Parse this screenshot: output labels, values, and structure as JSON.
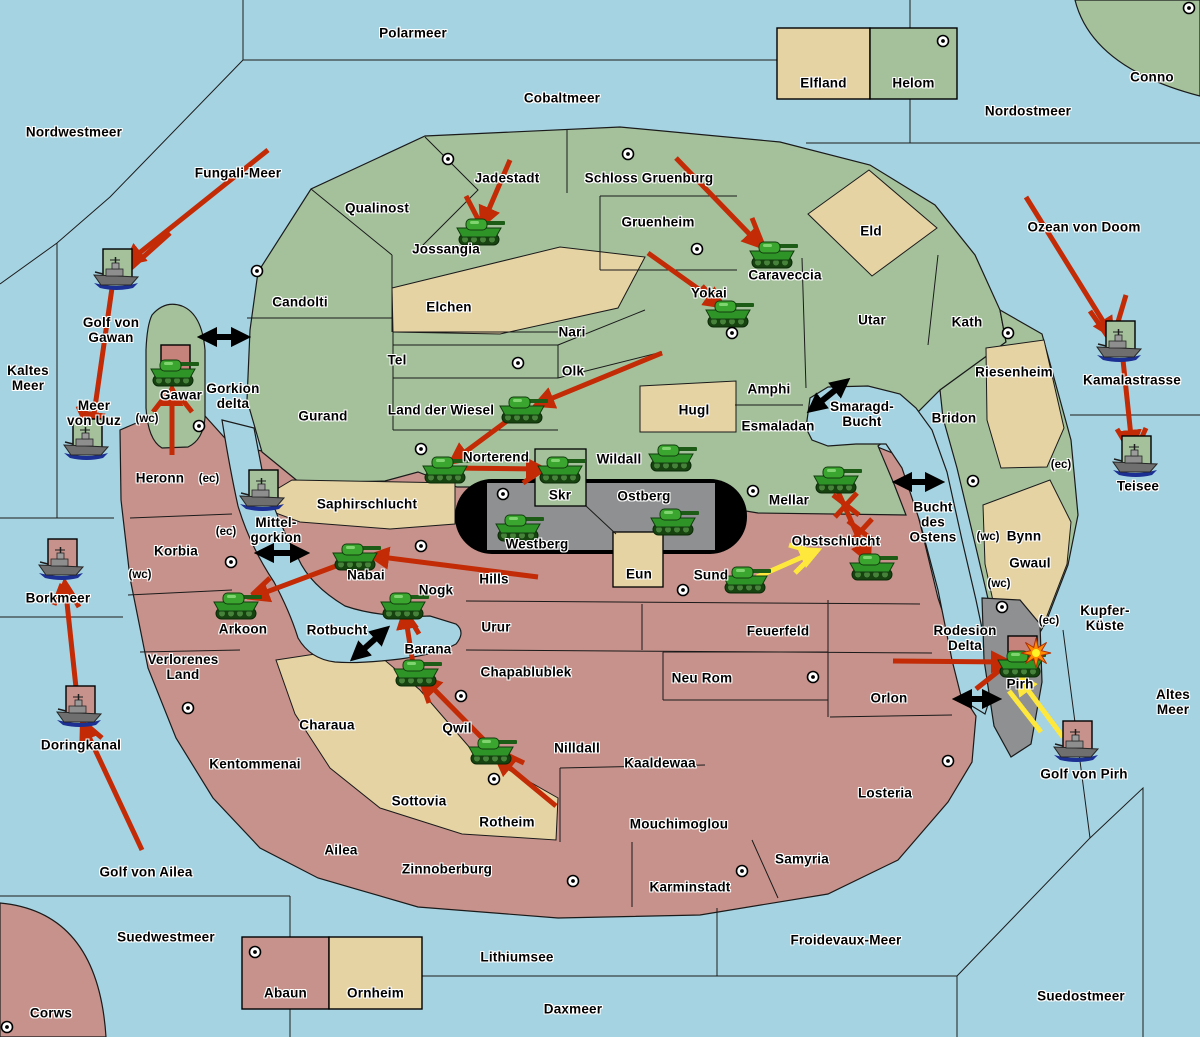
{
  "map": {
    "width": 1200,
    "height": 1037
  },
  "colors": {
    "sea": "#A6D3E2",
    "green": "#A4C19B",
    "red": "#C6928B",
    "tan": "#E5D3A4",
    "gray": "#8F9091",
    "band_black": "#000000",
    "border": "#1a1a1a",
    "arrow_red": "#C22B06",
    "arrow_yellow": "#FFE83C",
    "box_green": "#A4C19B",
    "box_pink": "#C6928B",
    "box_red": "#C6837B",
    "explosion_outer": "#FF8A00",
    "explosion_inner": "#FFF426"
  },
  "labels": [
    {
      "t": "Nordwestmeer",
      "x": 74,
      "y": 132,
      "side": "water"
    },
    {
      "t": "Polarmeer",
      "x": 413,
      "y": 33,
      "side": "water"
    },
    {
      "t": "Cobaltmeer",
      "x": 562,
      "y": 98,
      "side": "water"
    },
    {
      "t": "Nordostmeer",
      "x": 1028,
      "y": 111,
      "side": "water"
    },
    {
      "t": "Fungali-Meer",
      "x": 238,
      "y": 173,
      "side": "water"
    },
    {
      "t": "Ozean von Doom",
      "x": 1084,
      "y": 227,
      "side": "water"
    },
    {
      "t": "Conno",
      "x": 1152,
      "y": 77,
      "side": "green"
    },
    {
      "t": "Golf von\nGawan",
      "x": 111,
      "y": 330,
      "side": "water"
    },
    {
      "t": "Kaltes\nMeer",
      "x": 28,
      "y": 378,
      "side": "water"
    },
    {
      "t": "Meer\nvon Uuz",
      "x": 94,
      "y": 413,
      "side": "water"
    },
    {
      "t": "Gorkion\ndelta",
      "x": 233,
      "y": 396,
      "side": "water"
    },
    {
      "t": "Mittel-\ngorkion",
      "x": 276,
      "y": 530,
      "side": "water"
    },
    {
      "t": "Borkmeer",
      "x": 58,
      "y": 598,
      "side": "water"
    },
    {
      "t": "Rotbucht",
      "x": 337,
      "y": 630,
      "side": "water"
    },
    {
      "t": "Doringkanal",
      "x": 81,
      "y": 745,
      "side": "water"
    },
    {
      "t": "Golf von Ailea",
      "x": 146,
      "y": 872,
      "side": "water"
    },
    {
      "t": "Suedwestmeer",
      "x": 166,
      "y": 937,
      "side": "water"
    },
    {
      "t": "Lithiumsee",
      "x": 517,
      "y": 957,
      "side": "water"
    },
    {
      "t": "Daxmeer",
      "x": 573,
      "y": 1009,
      "side": "water"
    },
    {
      "t": "Froidevaux-Meer",
      "x": 846,
      "y": 940,
      "side": "water"
    },
    {
      "t": "Suedostmeer",
      "x": 1081,
      "y": 996,
      "side": "water"
    },
    {
      "t": "Altes\nMeer",
      "x": 1173,
      "y": 702,
      "side": "water"
    },
    {
      "t": "Kupfer-\nKüste",
      "x": 1105,
      "y": 618,
      "side": "water"
    },
    {
      "t": "Golf von Pirh",
      "x": 1084,
      "y": 774,
      "side": "water"
    },
    {
      "t": "Kamalastrasse",
      "x": 1132,
      "y": 380,
      "side": "water"
    },
    {
      "t": "Teisee",
      "x": 1138,
      "y": 486,
      "side": "water"
    },
    {
      "t": "Smaragd-\nBucht",
      "x": 862,
      "y": 414,
      "side": "water"
    },
    {
      "t": "Bucht\ndes\nOstens",
      "x": 933,
      "y": 522,
      "side": "water"
    },
    {
      "t": "Qualinost",
      "x": 377,
      "y": 208,
      "side": "green"
    },
    {
      "t": "Jadestadt",
      "x": 507,
      "y": 178,
      "side": "green"
    },
    {
      "t": "Schloss Gruenburg",
      "x": 649,
      "y": 178,
      "side": "green"
    },
    {
      "t": "Jossangia",
      "x": 446,
      "y": 249,
      "side": "green"
    },
    {
      "t": "Candolti",
      "x": 300,
      "y": 302,
      "side": "green"
    },
    {
      "t": "Elchen",
      "x": 449,
      "y": 307,
      "side": "neutral"
    },
    {
      "t": "Gruenheim",
      "x": 658,
      "y": 222,
      "side": "green"
    },
    {
      "t": "Caraveccia",
      "x": 785,
      "y": 275,
      "side": "green"
    },
    {
      "t": "Eld",
      "x": 871,
      "y": 231,
      "side": "neutral"
    },
    {
      "t": "Yokai",
      "x": 709,
      "y": 293,
      "side": "green"
    },
    {
      "t": "Nari",
      "x": 572,
      "y": 332,
      "side": "green"
    },
    {
      "t": "Tel",
      "x": 397,
      "y": 360,
      "side": "green"
    },
    {
      "t": "Olk",
      "x": 573,
      "y": 371,
      "side": "green"
    },
    {
      "t": "Utar",
      "x": 872,
      "y": 320,
      "side": "green"
    },
    {
      "t": "Kath",
      "x": 967,
      "y": 322,
      "side": "green"
    },
    {
      "t": "Gurand",
      "x": 323,
      "y": 416,
      "side": "green"
    },
    {
      "t": "Land der Wiesel",
      "x": 441,
      "y": 410,
      "side": "green"
    },
    {
      "t": "Hugl",
      "x": 694,
      "y": 410,
      "side": "neutral"
    },
    {
      "t": "Amphi",
      "x": 769,
      "y": 389,
      "side": "green"
    },
    {
      "t": "Esmaladan",
      "x": 778,
      "y": 426,
      "side": "green"
    },
    {
      "t": "Riesenheim",
      "x": 1014,
      "y": 372,
      "side": "neutral"
    },
    {
      "t": "Bridon",
      "x": 954,
      "y": 418,
      "side": "green"
    },
    {
      "t": "Norterend",
      "x": 496,
      "y": 457,
      "side": "green"
    },
    {
      "t": "Wildall",
      "x": 619,
      "y": 459,
      "side": "green"
    },
    {
      "t": "Mellar",
      "x": 789,
      "y": 500,
      "side": "green"
    },
    {
      "t": "Skr",
      "x": 560,
      "y": 495,
      "side": "green"
    },
    {
      "t": "Ostberg",
      "x": 644,
      "y": 496,
      "side": "gray"
    },
    {
      "t": "Westberg",
      "x": 537,
      "y": 544,
      "side": "gray"
    },
    {
      "t": "Eun",
      "x": 639,
      "y": 574,
      "side": "neutral"
    },
    {
      "t": "Bynn",
      "x": 1024,
      "y": 536,
      "side": "neutral"
    },
    {
      "t": "Gwaul",
      "x": 1030,
      "y": 563,
      "side": "neutral"
    },
    {
      "t": "Gawar",
      "x": 181,
      "y": 395,
      "side": "green"
    },
    {
      "t": "Saphirschlucht",
      "x": 367,
      "y": 504,
      "side": "neutral"
    },
    {
      "t": "Heronn",
      "x": 160,
      "y": 478,
      "side": "red"
    },
    {
      "t": "Korbia",
      "x": 176,
      "y": 551,
      "side": "red"
    },
    {
      "t": "Nabai",
      "x": 366,
      "y": 575,
      "side": "red"
    },
    {
      "t": "Arkoon",
      "x": 243,
      "y": 629,
      "side": "red"
    },
    {
      "t": "Verlorenes\nLand",
      "x": 183,
      "y": 667,
      "side": "red"
    },
    {
      "t": "Kentommenai",
      "x": 255,
      "y": 764,
      "side": "red"
    },
    {
      "t": "Hills",
      "x": 494,
      "y": 579,
      "side": "red"
    },
    {
      "t": "Sund",
      "x": 711,
      "y": 575,
      "side": "red"
    },
    {
      "t": "Obstschlucht",
      "x": 836,
      "y": 541,
      "side": "red"
    },
    {
      "t": "Nogk",
      "x": 436,
      "y": 590,
      "side": "red"
    },
    {
      "t": "Urur",
      "x": 496,
      "y": 627,
      "side": "red"
    },
    {
      "t": "Feuerfeld",
      "x": 778,
      "y": 631,
      "side": "red"
    },
    {
      "t": "Barana",
      "x": 428,
      "y": 649,
      "side": "red"
    },
    {
      "t": "Chapablublek",
      "x": 526,
      "y": 672,
      "side": "red"
    },
    {
      "t": "Neu Rom",
      "x": 702,
      "y": 678,
      "side": "red"
    },
    {
      "t": "Orlon",
      "x": 889,
      "y": 698,
      "side": "red"
    },
    {
      "t": "Qwil",
      "x": 457,
      "y": 728,
      "side": "red"
    },
    {
      "t": "Nilldall",
      "x": 577,
      "y": 748,
      "side": "red"
    },
    {
      "t": "Kaaldewaa",
      "x": 660,
      "y": 763,
      "side": "red"
    },
    {
      "t": "Rotheim",
      "x": 507,
      "y": 822,
      "side": "red"
    },
    {
      "t": "Mouchimoglou",
      "x": 679,
      "y": 824,
      "side": "red"
    },
    {
      "t": "Losteria",
      "x": 885,
      "y": 793,
      "side": "red"
    },
    {
      "t": "Ailea",
      "x": 341,
      "y": 850,
      "side": "red"
    },
    {
      "t": "Zinnoberburg",
      "x": 447,
      "y": 869,
      "side": "red"
    },
    {
      "t": "Samyria",
      "x": 802,
      "y": 859,
      "side": "red"
    },
    {
      "t": "Karminstadt",
      "x": 690,
      "y": 887,
      "side": "red"
    },
    {
      "t": "Charaua",
      "x": 327,
      "y": 725,
      "side": "neutral"
    },
    {
      "t": "Sottovia",
      "x": 419,
      "y": 801,
      "side": "neutral"
    },
    {
      "t": "Rodesion\nDelta",
      "x": 965,
      "y": 638,
      "side": "gray"
    },
    {
      "t": "Pirh",
      "x": 1020,
      "y": 684,
      "side": "gray"
    },
    {
      "t": "Corws",
      "x": 51,
      "y": 1013,
      "side": "red"
    }
  ],
  "tags": [
    {
      "t": "(wc)",
      "x": 147,
      "y": 419
    },
    {
      "t": "(wc)",
      "x": 140,
      "y": 575
    },
    {
      "t": "(wc)",
      "x": 988,
      "y": 537
    },
    {
      "t": "(wc)",
      "x": 999,
      "y": 584
    },
    {
      "t": "(ec)",
      "x": 209,
      "y": 479
    },
    {
      "t": "(ec)",
      "x": 226,
      "y": 532
    },
    {
      "t": "(ec)",
      "x": 1061,
      "y": 465
    },
    {
      "t": "(ec)",
      "x": 1049,
      "y": 621
    }
  ],
  "cities": [
    [
      448,
      159
    ],
    [
      628,
      154
    ],
    [
      943,
      41
    ],
    [
      1189,
      8
    ],
    [
      257,
      271
    ],
    [
      697,
      249
    ],
    [
      732,
      333
    ],
    [
      518,
      363
    ],
    [
      1008,
      333
    ],
    [
      421,
      449
    ],
    [
      503,
      494
    ],
    [
      753,
      491
    ],
    [
      973,
      481
    ],
    [
      199,
      426
    ],
    [
      231,
      562
    ],
    [
      421,
      546
    ],
    [
      683,
      590
    ],
    [
      1002,
      607
    ],
    [
      188,
      708
    ],
    [
      461,
      696
    ],
    [
      494,
      779
    ],
    [
      813,
      677
    ],
    [
      948,
      761
    ],
    [
      573,
      881
    ],
    [
      742,
      871
    ],
    [
      7,
      1027
    ],
    [
      255,
      952
    ]
  ],
  "tanks": [
    [
      479,
      232
    ],
    [
      772,
      255
    ],
    [
      728,
      314
    ],
    [
      522,
      410
    ],
    [
      445,
      470
    ],
    [
      560,
      470
    ],
    [
      671,
      458
    ],
    [
      518,
      528
    ],
    [
      673,
      522
    ],
    [
      836,
      480
    ],
    [
      872,
      567
    ],
    [
      745,
      580
    ],
    [
      355,
      557
    ],
    [
      236,
      606
    ],
    [
      403,
      606
    ],
    [
      416,
      673
    ],
    [
      491,
      751
    ],
    [
      173,
      373,
      "red"
    ],
    [
      1020,
      664,
      "red"
    ]
  ],
  "ships": [
    [
      117,
      275,
      "green"
    ],
    [
      87,
      445,
      "green"
    ],
    [
      263,
      496,
      "green"
    ],
    [
      1120,
      347,
      "green"
    ],
    [
      1136,
      462,
      "green"
    ],
    [
      62,
      565,
      "pink"
    ],
    [
      80,
      712,
      "pink"
    ],
    [
      1077,
      747,
      "pink"
    ]
  ],
  "arrows": [
    [
      268,
      150,
      128,
      262,
      "r",
      1
    ],
    [
      170,
      233,
      131,
      268,
      "r",
      0
    ],
    [
      112,
      288,
      92,
      428,
      "r",
      1
    ],
    [
      78,
      406,
      90,
      432,
      "r",
      0
    ],
    [
      172,
      455,
      172,
      390,
      "r",
      1
    ],
    [
      153,
      412,
      167,
      394,
      "r",
      0
    ],
    [
      192,
      412,
      178,
      394,
      "r",
      0
    ],
    [
      510,
      160,
      483,
      223,
      "r",
      1
    ],
    [
      466,
      196,
      479,
      221,
      "r",
      0
    ],
    [
      676,
      158,
      760,
      245,
      "r",
      1
    ],
    [
      752,
      218,
      762,
      243,
      "r",
      0
    ],
    [
      648,
      253,
      721,
      305,
      "r",
      1
    ],
    [
      702,
      286,
      719,
      304,
      "r",
      0
    ],
    [
      662,
      353,
      538,
      404,
      "r",
      1
    ],
    [
      515,
      415,
      453,
      461,
      "r",
      1
    ],
    [
      450,
      468,
      542,
      469,
      "r",
      1
    ],
    [
      523,
      483,
      541,
      471,
      "r",
      0
    ],
    [
      1026,
      197,
      1111,
      334,
      "r",
      1
    ],
    [
      1090,
      311,
      1108,
      337,
      "r",
      0
    ],
    [
      1126,
      295,
      1115,
      332,
      "r",
      0
    ],
    [
      1123,
      360,
      1132,
      446,
      "r",
      1
    ],
    [
      1117,
      429,
      1129,
      449,
      "r",
      0
    ],
    [
      1146,
      428,
      1136,
      450,
      "r",
      0
    ],
    [
      538,
      577,
      373,
      556,
      "r",
      1
    ],
    [
      352,
      560,
      253,
      597,
      "r",
      1
    ],
    [
      270,
      578,
      252,
      595,
      "r",
      0
    ],
    [
      836,
      487,
      868,
      559,
      "r",
      1
    ],
    [
      893,
      661,
      1007,
      662,
      "r",
      1
    ],
    [
      976,
      689,
      1005,
      666,
      "r",
      0
    ],
    [
      556,
      806,
      498,
      758,
      "r",
      1
    ],
    [
      524,
      763,
      503,
      753,
      "r",
      0
    ],
    [
      488,
      744,
      424,
      679,
      "r",
      1
    ],
    [
      429,
      703,
      420,
      677,
      "r",
      0
    ],
    [
      413,
      664,
      405,
      613,
      "r",
      1
    ],
    [
      419,
      634,
      407,
      614,
      "r",
      0
    ],
    [
      142,
      850,
      83,
      724,
      "r",
      1
    ],
    [
      102,
      738,
      88,
      726,
      "r",
      0
    ],
    [
      77,
      697,
      65,
      584,
      "r",
      1
    ],
    [
      54,
      605,
      62,
      584,
      "r",
      0
    ],
    [
      79,
      607,
      67,
      586,
      "r",
      0
    ],
    [
      757,
      577,
      816,
      551,
      "y",
      1
    ],
    [
      789,
      545,
      814,
      552,
      "y",
      0
    ],
    [
      795,
      573,
      815,
      553,
      "y",
      0
    ],
    [
      1063,
      737,
      1019,
      678,
      "y",
      1
    ],
    [
      1041,
      732,
      1009,
      691,
      "y",
      0
    ]
  ],
  "links": [
    [
      205,
      337,
      243,
      337
    ],
    [
      262,
      553,
      302,
      553
    ],
    [
      813,
      408,
      844,
      383
    ],
    [
      900,
      482,
      937,
      482
    ],
    [
      356,
      656,
      384,
      631
    ],
    [
      960,
      699,
      994,
      699
    ]
  ],
  "battles": [
    [
      846,
      505
    ],
    [
      861,
      531
    ]
  ],
  "explosions": [
    [
      1036,
      653
    ]
  ],
  "legend_top": {
    "x": 777,
    "y": 28,
    "h": 71,
    "cells": [
      {
        "label": "Elfland",
        "color": "tan",
        "w": 93,
        "city": false
      },
      {
        "label": "Helom",
        "color": "green",
        "w": 87,
        "city": true
      }
    ]
  },
  "legend_bottom": {
    "x": 242,
    "y": 937,
    "h": 72,
    "cells": [
      {
        "label": "Abaun",
        "color": "red",
        "w": 87,
        "city": true
      },
      {
        "label": "Ornheim",
        "color": "tan",
        "w": 93,
        "city": false
      }
    ]
  }
}
